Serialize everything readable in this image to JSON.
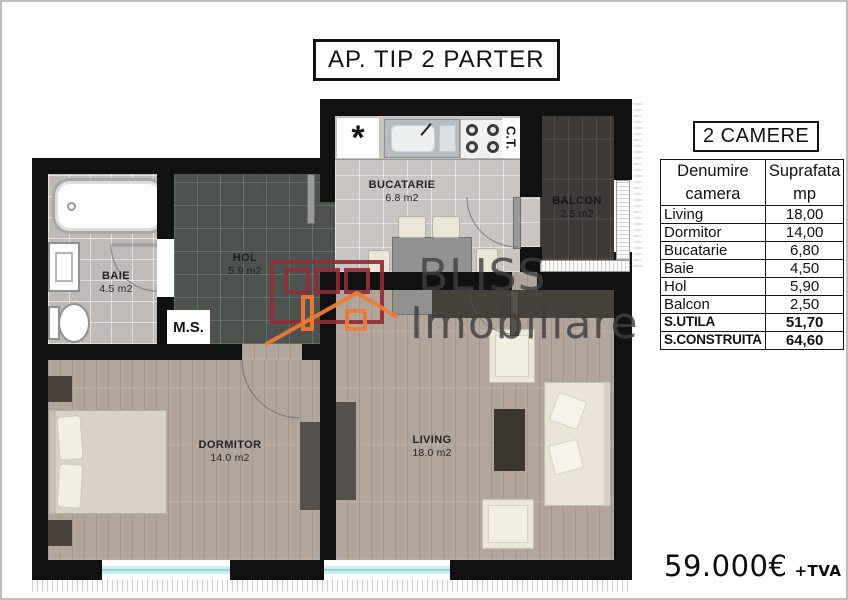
{
  "title": "AP. TIP 2 PARTER",
  "watermark": {
    "brand_line1": "BLISS",
    "brand_line2": "Imobiliare"
  },
  "plan": {
    "rooms": {
      "bucatarie": {
        "label": "BUCATARIE",
        "area": "6.8 m2"
      },
      "balcon": {
        "label": "BALCON",
        "area": "2.5 m2"
      },
      "baie": {
        "label": "BAIE",
        "area": "4.5 m2"
      },
      "hol": {
        "label": "HOL",
        "area": "5.9 m2"
      },
      "dormitor": {
        "label": "DORMITOR",
        "area": "14.0 m2"
      },
      "living": {
        "label": "LIVING",
        "area": "18.0 m2"
      }
    },
    "labels": {
      "washing_machine": "M.S.",
      "boiler": "C.T.",
      "hob_symbol": "*"
    }
  },
  "panel": {
    "heading": "2 CAMERE",
    "table": {
      "header": {
        "col1_line1": "Denumire",
        "col1_line2": "camera",
        "col2_line1": "Suprafata",
        "col2_line2": "mp"
      },
      "rows": [
        {
          "name": "Living",
          "value": "18,00"
        },
        {
          "name": "Dormitor",
          "value": "14,00"
        },
        {
          "name": "Bucatarie",
          "value": "6,80"
        },
        {
          "name": "Baie",
          "value": "4,50"
        },
        {
          "name": "Hol",
          "value": "5,90"
        },
        {
          "name": "Balcon",
          "value": "2,50"
        },
        {
          "name": "S.UTILA",
          "value": "51,70"
        },
        {
          "name": "S.CONSTRUITA",
          "value": "64,60"
        }
      ]
    },
    "price": {
      "amount": "59.000€",
      "suffix": "+TVA"
    }
  },
  "colors": {
    "wall": "#111111",
    "logo_maroon": "#8e2f37",
    "logo_orange": "#ef7a35",
    "wood_floor": "#b2a59b",
    "balcony_wood": "#3c3936",
    "hol_tile": "#4d524e",
    "bath_tile": "#bdbab7",
    "window_glass": "#9fd3d8",
    "watermark_text": "#3f3f3f"
  }
}
